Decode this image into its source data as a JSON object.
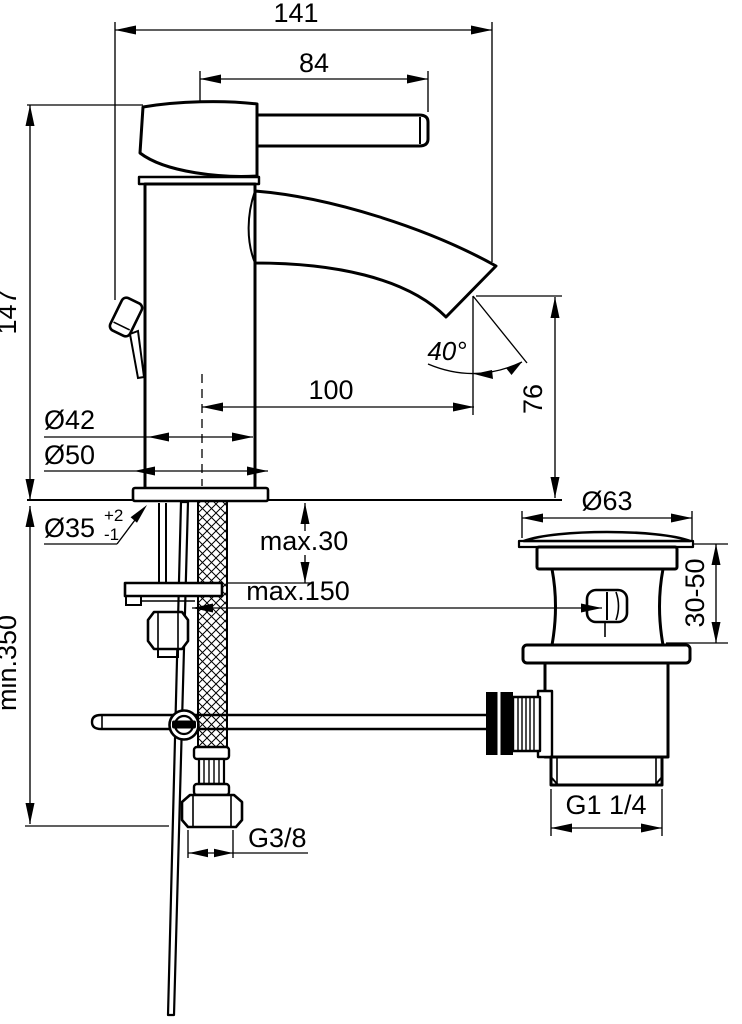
{
  "drawing": {
    "type": "technical-dimension-drawing",
    "subject": "single-lever basin mixer with pop-up waste",
    "labels": {
      "total_depth": "141",
      "handle_length": "84",
      "body_height": "147",
      "spout_angle": "40°",
      "spout_reach": "100",
      "spout_height": "76",
      "body_diameter": "Ø42",
      "base_diameter": "Ø50",
      "hole_diameter": "Ø35",
      "hole_tol_plus": "+2",
      "hole_tol_minus": "-1",
      "max_deck_thickness": "max.30",
      "max_waste_distance": "max.150",
      "min_hose_length": "min.350",
      "supply_thread": "G3/8",
      "waste_flange_diameter": "Ø63",
      "waste_body_range": "30-50",
      "waste_thread": "G1 1/4"
    },
    "line_color": "#000000",
    "background_color": "#ffffff"
  }
}
